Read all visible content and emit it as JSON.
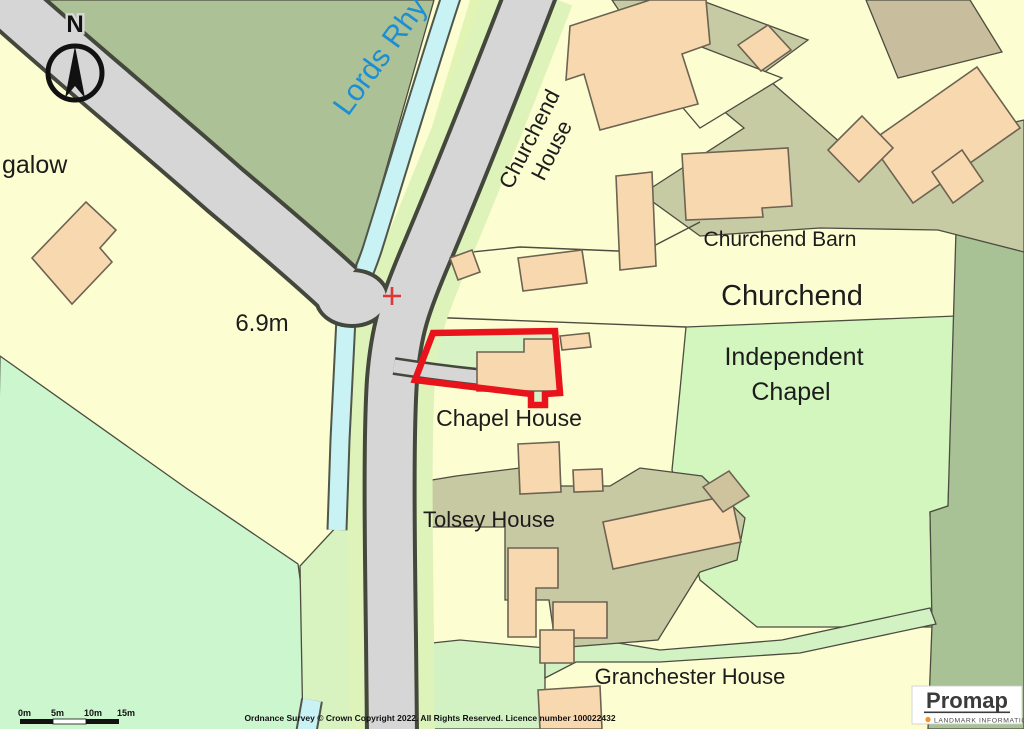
{
  "map": {
    "place_labels": {
      "bungalow_partial": "galow",
      "stream_name": "Lords Rhy",
      "churchend_house_line1": "Churchend",
      "churchend_house_line2": "House",
      "churchend_barn": "Churchend Barn",
      "settlement": "Churchend",
      "independent_chapel_line1": "Independent",
      "independent_chapel_line2": "Chapel",
      "chapel_house": "Chapel House",
      "tolsey_house": "Tolsey House",
      "granchester_house": "Granchester House",
      "spot_height": "6.9m"
    },
    "north_arrow_label": "N",
    "scale_bar": {
      "labels": [
        "0m",
        "5m",
        "10m",
        "15m"
      ]
    },
    "copyright": "Ordnance Survey © Crown Copyright 2022. All Rights Reserved. Licence number 100022432",
    "branding": {
      "name": "Promap",
      "tagline": "LANDMARK INFORMATION"
    },
    "colors": {
      "selection_boundary": "#e8131b",
      "building": "#f8d8af",
      "parcel_yellow": "#fcfdd0",
      "field_mint": "#ccf6ce",
      "woodland_sage": "#acc296",
      "grass_light_green": "#d3f6bf",
      "yard_khaki": "#c7cba4",
      "road_gray": "#d6d6d6",
      "water_cyan": "#c9f2f5",
      "water_label_blue": "#1c8fd4"
    }
  }
}
